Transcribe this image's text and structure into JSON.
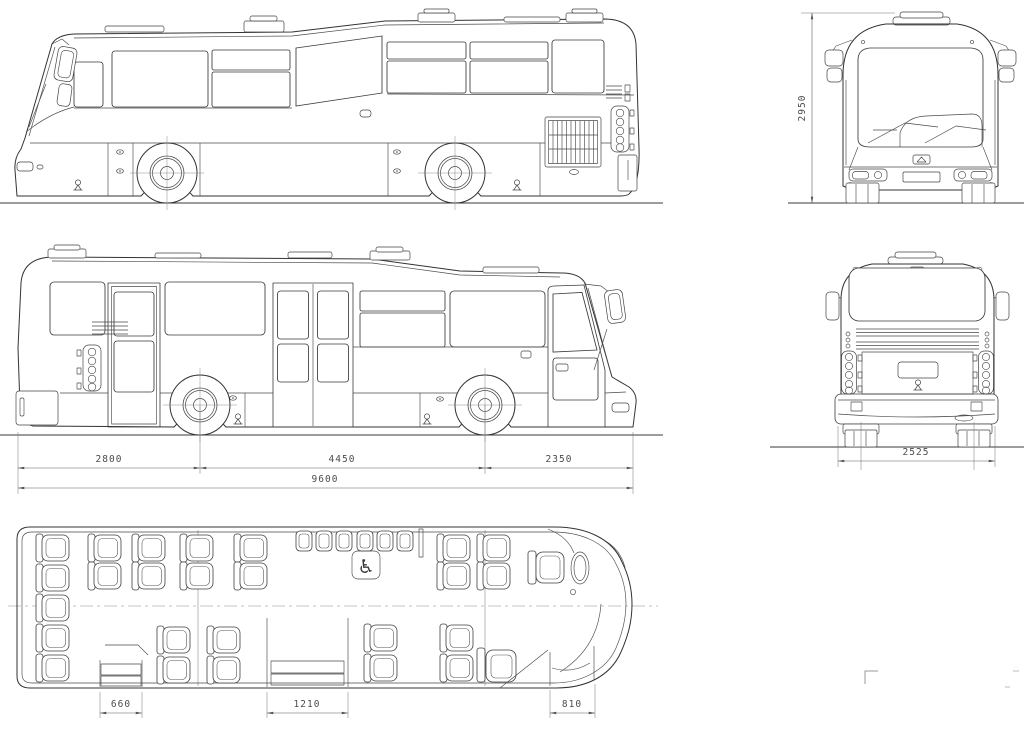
{
  "drawing": {
    "background": "#ffffff",
    "line_color": "#3a3a3a",
    "dimension_color": "#4c4c4c"
  },
  "dimensions": {
    "overall_height": "2950",
    "rear_overhang": "2800",
    "wheelbase": "4450",
    "front_overhang": "2350",
    "overall_length": "9600",
    "overall_width": "2525",
    "rear_door_width": "660",
    "middle_door_width": "1210",
    "front_door_width": "810"
  },
  "icons": {
    "wheelchair": "♿"
  }
}
